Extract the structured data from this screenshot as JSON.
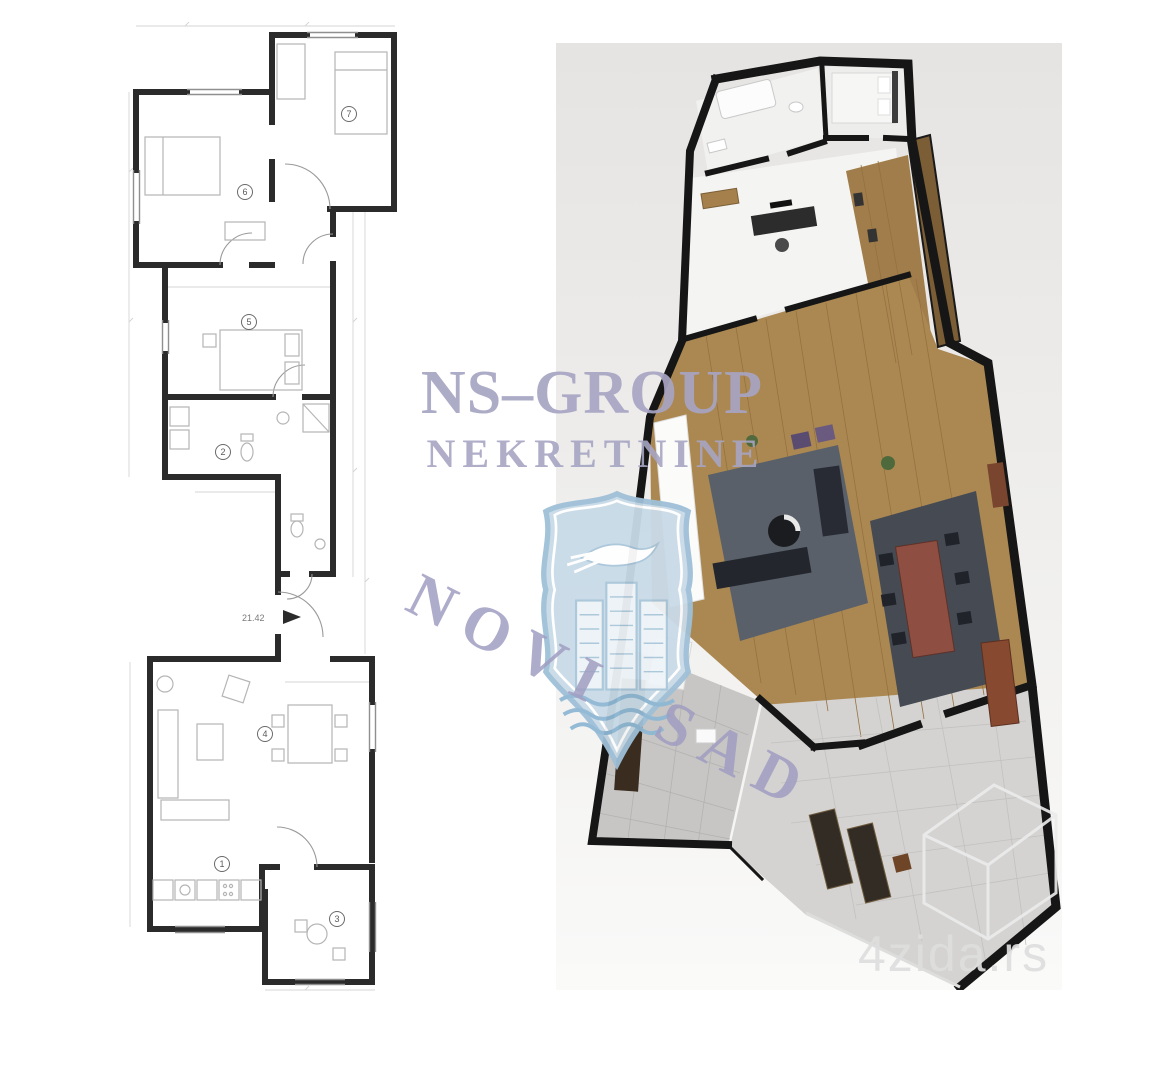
{
  "watermark": {
    "brand_line1": "NS–GROUP",
    "brand_line2": "NEKRETNINE",
    "city_text": "NOVI SAD",
    "text_color": "#a7a5c3",
    "shield_fill": "#c9dbe8",
    "shield_stroke": "#9fc0d8"
  },
  "site_watermark": {
    "label": "4zida.rs",
    "color": "#dedede"
  },
  "plan2d": {
    "entrance_label": "21.42",
    "wall_color": "#2b2b2b",
    "room_markers": [
      "1",
      "2",
      "3",
      "4",
      "5",
      "6",
      "7"
    ]
  },
  "plan3d": {
    "wall_color": "#161616",
    "wood_floor_color": "#ab8852",
    "tile_floor_color": "#cfcecc",
    "dining_table_color": "#8e4f42",
    "background_color": "#e9e7e5"
  }
}
